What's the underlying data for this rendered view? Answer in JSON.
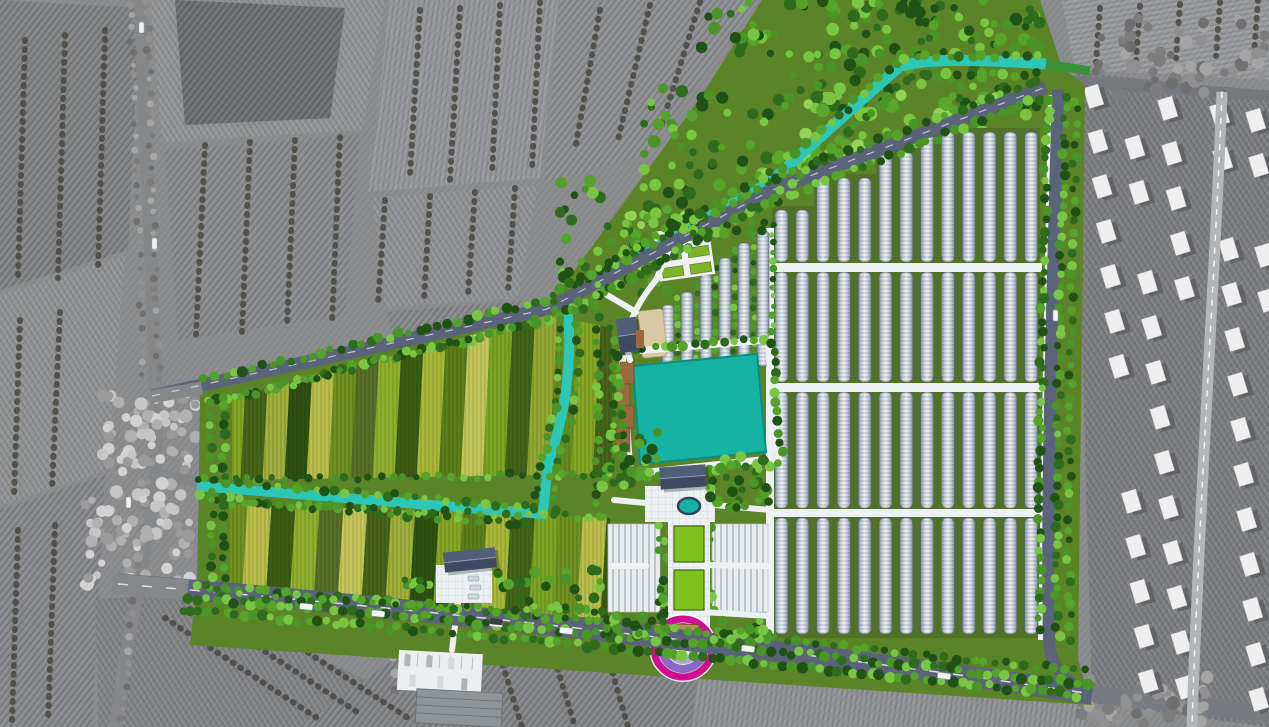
{
  "meta": {
    "title": "Aerial master-plan rendering of an agricultural eco-park",
    "canvas": {
      "w": 1269,
      "h": 727
    }
  },
  "palette": {
    "context_base": "#8a8c8e",
    "context_tones": [
      "#7f8183",
      "#8f9193",
      "#85878a",
      "#909294",
      "#6b6d70",
      "#888a8d",
      "#94969a",
      "#8b8d90",
      "#8f9194",
      "#818386",
      "#8e9092",
      "#97999c",
      "#7c7e81"
    ],
    "context_tree": "#46483f",
    "context_tree_light": [
      "#c6c6c6",
      "#b0b0b0",
      "#9a9a9a",
      "#d2d2d2"
    ],
    "context_tree_gray": [
      "#909090",
      "#7d7d7d",
      "#a5a5a5",
      "#6f6f6f"
    ],
    "context_road": "#858789",
    "village_road": "#b3b6b9",
    "house_roof": "#efefef",
    "house_shadow": "#5f6064",
    "lawn": "#5a8427",
    "field_under": "#4f7226",
    "site_road": "#59637a",
    "road_dash": "#e8eaec",
    "canal": "#2cc7b6",
    "canal_exit_green": "#3a8f3a",
    "pond": "#16b3a2",
    "pond_edge": "#0d8d80",
    "path_white": "#eef1f3",
    "path_line": "#ccd2d8",
    "tree_greens": [
      "#2e6b1c",
      "#56a32b",
      "#79c544",
      "#1f5214",
      "#4b9428"
    ],
    "tree_bright": [
      "#7cc43f",
      "#5aa52e",
      "#93d355"
    ],
    "farm_north_colors": [
      "#87a826",
      "#49641b",
      "#9fb03b",
      "#2f5212",
      "#b9bf4a",
      "#6f9220",
      "#586f2a",
      "#8fb02c",
      "#3c5c14",
      "#a8b838",
      "#5d7f1b",
      "#c3c75a",
      "#7aa524",
      "#43651a",
      "#93a832",
      "#688b1e"
    ],
    "farm_south_colors": [
      "#6f9220",
      "#b9bf4a",
      "#3c5c14",
      "#8fb02c",
      "#586f2a",
      "#c3c75a",
      "#49641b",
      "#9fb03b",
      "#2f5212",
      "#87a826",
      "#5d7f1b",
      "#a8b838",
      "#43651a",
      "#7aa524"
    ],
    "greenhouse_edge": "#5d6b79",
    "greenhouse_light": "#eef3f5",
    "greenhouse_mid": "#c7d2d9",
    "greenhouse_dark": "#7f93a4",
    "boardwalk": "#9a6a3e",
    "sand": "#d9c9a2",
    "roof_dark": "#3d4a61",
    "roof_dark2": "#55647e",
    "plaza_block": "#e9edef",
    "entrance_ring": "#cf0e92",
    "entrance_band1": "#8a68c6",
    "entrance_band2": "#b9a3dd",
    "gate_bar": "#b98a5c",
    "car_white": "#f2f3f4",
    "car_dark": "#3a3f46"
  },
  "scene": {
    "site_boundary": [
      [
        200,
        390
      ],
      [
        547,
        308
      ],
      [
        700,
        98
      ],
      [
        762,
        0
      ],
      [
        1040,
        0
      ],
      [
        1062,
        68
      ],
      [
        1085,
        85
      ],
      [
        1078,
        660
      ],
      [
        1092,
        705
      ],
      [
        190,
        645
      ],
      [
        197,
        585
      ],
      [
        199,
        478
      ]
    ],
    "context_fields": [
      {
        "pts": [
          [
            0,
            0
          ],
          [
            140,
            8
          ],
          [
            128,
            250
          ],
          [
            0,
            290
          ]
        ],
        "tone": 0,
        "hatch": "h1"
      },
      {
        "pts": [
          [
            0,
            295
          ],
          [
            125,
            255
          ],
          [
            108,
            470
          ],
          [
            0,
            505
          ]
        ],
        "tone": 1,
        "hatch": "h2"
      },
      {
        "pts": [
          [
            0,
            510
          ],
          [
            105,
            475
          ],
          [
            92,
            727
          ],
          [
            0,
            727
          ]
        ],
        "tone": 2,
        "hatch": "h1"
      },
      {
        "pts": [
          [
            150,
            0
          ],
          [
            385,
            0
          ],
          [
            362,
            130
          ],
          [
            162,
            142
          ]
        ],
        "tone": 3,
        "hatch": "h2"
      },
      {
        "pts": [
          [
            175,
            0
          ],
          [
            345,
            8
          ],
          [
            330,
            118
          ],
          [
            185,
            125
          ]
        ],
        "tone": 4,
        "hatch": "h1"
      },
      {
        "pts": [
          [
            165,
            150
          ],
          [
            360,
            135
          ],
          [
            345,
            315
          ],
          [
            178,
            340
          ]
        ],
        "tone": 5,
        "hatch": "h1"
      },
      {
        "pts": [
          [
            390,
            0
          ],
          [
            558,
            0
          ],
          [
            540,
            178
          ],
          [
            368,
            192
          ]
        ],
        "tone": 6,
        "hatch": "h3"
      },
      {
        "pts": [
          [
            560,
            0
          ],
          [
            758,
            0
          ],
          [
            645,
            155
          ],
          [
            545,
            182
          ]
        ],
        "tone": 7,
        "hatch": "h1"
      },
      {
        "pts": [
          [
            372,
            198
          ],
          [
            538,
            185
          ],
          [
            518,
            298
          ],
          [
            385,
            308
          ]
        ],
        "tone": 8,
        "hatch": "h2"
      },
      {
        "pts": [
          [
            388,
            312
          ],
          [
            532,
            300
          ],
          [
            430,
            358
          ],
          [
            396,
            354
          ]
        ],
        "tone": 2,
        "hatch": "h1"
      },
      {
        "pts": [
          [
            95,
            600
          ],
          [
            178,
            592
          ],
          [
            420,
            705
          ],
          [
            330,
            727
          ],
          [
            98,
            727
          ]
        ],
        "tone": 9,
        "hatch": "h2"
      },
      {
        "pts": [
          [
            300,
            727
          ],
          [
            420,
            640
          ],
          [
            700,
            662
          ],
          [
            690,
            727
          ]
        ],
        "tone": 9,
        "hatch": "h1"
      },
      {
        "pts": [
          [
            690,
            727
          ],
          [
            700,
            662
          ],
          [
            1090,
            700
          ],
          [
            1085,
            727
          ]
        ],
        "tone": 10,
        "hatch": "h3"
      },
      {
        "pts": [
          [
            1062,
            0
          ],
          [
            1269,
            0
          ],
          [
            1269,
            80
          ],
          [
            1075,
            70
          ]
        ],
        "tone": 11,
        "hatch": "hv"
      },
      {
        "pts": [
          [
            1075,
            72
          ],
          [
            1269,
            92
          ],
          [
            1269,
            727
          ],
          [
            1092,
            703
          ]
        ],
        "tone": 12,
        "hatch": "h2"
      }
    ],
    "context_tree_rows": [
      [
        [
          420,
          10
        ],
        [
          410,
          175
        ]
      ],
      [
        [
          460,
          8
        ],
        [
          450,
          180
        ]
      ],
      [
        [
          500,
          5
        ],
        [
          492,
          175
        ]
      ],
      [
        [
          540,
          2
        ],
        [
          532,
          170
        ]
      ],
      [
        [
          205,
          145
        ],
        [
          196,
          335
        ]
      ],
      [
        [
          250,
          142
        ],
        [
          242,
          332
        ]
      ],
      [
        [
          295,
          140
        ],
        [
          287,
          328
        ]
      ],
      [
        [
          340,
          137
        ],
        [
          332,
          322
        ]
      ],
      [
        [
          385,
          200
        ],
        [
          378,
          305
        ]
      ],
      [
        [
          430,
          196
        ],
        [
          424,
          300
        ]
      ],
      [
        [
          475,
          192
        ],
        [
          468,
          296
        ]
      ],
      [
        [
          515,
          188
        ],
        [
          508,
          292
        ]
      ],
      [
        [
          600,
          10
        ],
        [
          575,
          150
        ]
      ],
      [
        [
          650,
          5
        ],
        [
          618,
          140
        ]
      ],
      [
        [
          700,
          2
        ],
        [
          660,
          130
        ]
      ],
      [
        [
          25,
          40
        ],
        [
          18,
          280
        ]
      ],
      [
        [
          65,
          35
        ],
        [
          58,
          278
        ]
      ],
      [
        [
          105,
          30
        ],
        [
          98,
          272
        ]
      ],
      [
        [
          20,
          320
        ],
        [
          14,
          495
        ]
      ],
      [
        [
          60,
          312
        ],
        [
          52,
          488
        ]
      ],
      [
        [
          18,
          530
        ],
        [
          12,
          722
        ]
      ],
      [
        [
          55,
          525
        ],
        [
          48,
          722
        ]
      ],
      [
        [
          165,
          618
        ],
        [
          320,
          720
        ]
      ],
      [
        [
          205,
          612
        ],
        [
          360,
          714
        ]
      ],
      [
        [
          255,
          618
        ],
        [
          408,
          718
        ]
      ],
      [
        [
          445,
          652
        ],
        [
          470,
          727
        ]
      ],
      [
        [
          500,
          656
        ],
        [
          522,
          727
        ]
      ],
      [
        [
          555,
          660
        ],
        [
          575,
          727
        ]
      ],
      [
        [
          610,
          664
        ],
        [
          628,
          727
        ]
      ],
      [
        [
          1100,
          8
        ],
        [
          1096,
          62
        ]
      ],
      [
        [
          1140,
          6
        ],
        [
          1136,
          60
        ]
      ],
      [
        [
          1180,
          4
        ],
        [
          1176,
          58
        ]
      ],
      [
        [
          1220,
          2
        ],
        [
          1216,
          56
        ]
      ],
      [
        [
          1258,
          0
        ],
        [
          1254,
          54
        ]
      ]
    ],
    "farm_north": {
      "poly": [
        [
          232,
          398
        ],
        [
          548,
          315
        ],
        [
          612,
          328
        ],
        [
          612,
          474
        ],
        [
          232,
          480
        ]
      ],
      "x0": 228,
      "x1": 616,
      "strip_w": 22,
      "lean": 10,
      "y_top": 300,
      "y_bot": 490
    },
    "farm_south": {
      "poly": [
        [
          228,
          504
        ],
        [
          610,
          518
        ],
        [
          608,
          618
        ],
        [
          436,
          612
        ],
        [
          228,
          598
        ]
      ],
      "x0": 224,
      "x1": 614,
      "strip_w": 24,
      "lean": 8,
      "y_top": 498,
      "y_bot": 625
    },
    "canal_ne": "M566,300 L770,182 L900,66 C925,60 960,58 1046,64",
    "canal_exit": "M1046,64 L1090,71",
    "canal_sw": "M566,300 C574,352 566,408 552,452 C543,480 547,498 542,514 L197,486",
    "nw_road": "M152,396 L547,309 L770,191 L1046,87",
    "nw_road_gray": "M150,397 L202,388",
    "east_road": "M1058,90 C1052,300 1046,520 1049,640 C1050,668 1066,682 1088,693",
    "bottom_road": "M118,584 C400,606 800,650 1092,694",
    "bottom_road_gray": "M112,584 L188,590",
    "bottom_road_ext": "M1092,694 L1269,714",
    "left_road": "M140,0 C148,200 160,420 155,478 C150,540 125,640 116,727",
    "west_stub_road": "M152,474 L199,482",
    "village_v_road": "M1222,92 C1216,250 1204,430 1197,600 C1194,660 1193,695 1192,727",
    "tr_h_road": "M1062,80 L1269,96",
    "greenhouse_field": {
      "x0": 775,
      "spacing": 20.8,
      "row_w": 13,
      "rows": 13,
      "under": [
        [
          [
            772,
            206
          ],
          [
            814,
            206
          ],
          [
            814,
            174
          ],
          [
            876,
            174
          ],
          [
            876,
            148
          ],
          [
            918,
            148
          ],
          [
            918,
            128
          ],
          [
            1040,
            128
          ],
          [
            1040,
            266
          ],
          [
            772,
            266
          ]
        ],
        [
          [
            772,
            268
          ],
          [
            1040,
            268
          ],
          [
            1040,
            386
          ],
          [
            772,
            386
          ]
        ],
        [
          [
            772,
            388
          ],
          [
            1040,
            388
          ],
          [
            1040,
            512
          ],
          [
            772,
            512
          ]
        ],
        [
          [
            772,
            514
          ],
          [
            1040,
            514
          ],
          [
            1040,
            638
          ],
          [
            772,
            638
          ]
        ]
      ],
      "bands": [
        {
          "y1": 262,
          "tops": [
            210,
            210,
            178,
            178,
            178,
            152,
            152,
            132,
            132,
            132,
            132,
            132,
            132
          ]
        },
        {
          "y0": 272,
          "y1": 382
        },
        {
          "y0": 392,
          "y1": 508
        },
        {
          "y0": 518,
          "y1": 634
        }
      ],
      "h_paths": [
        [
          770,
          263,
          272,
          9
        ],
        [
          770,
          383,
          272,
          9
        ],
        [
          770,
          509,
          272,
          8
        ]
      ],
      "v_path_w": "M770,228 L770,640",
      "v_path_e": "M1052,95 L1042,640"
    },
    "nursery": {
      "xs": [
        662,
        681,
        700,
        719,
        738,
        757
      ],
      "tops": [
        305,
        292,
        275,
        258,
        243,
        231
      ],
      "bottom": 366,
      "w": 12
    },
    "garden_plots": {
      "x": 656,
      "y": 228,
      "w": 56,
      "h": 50,
      "rot": -8,
      "cols": 2,
      "rows": 3
    },
    "sand": {
      "x": 640,
      "y": 310,
      "w": 25,
      "h": 47,
      "rot": -6
    },
    "pond": {
      "pts": [
        [
          633,
          366
        ],
        [
          757,
          354
        ],
        [
          766,
          452
        ],
        [
          640,
          464
        ]
      ],
      "loop": [
        [
          622,
          352
        ],
        [
          768,
          340
        ],
        [
          778,
          458
        ],
        [
          630,
          474
        ]
      ]
    },
    "boardwalk": [
      [
        620,
        362,
        14,
        22
      ],
      [
        616,
        384,
        14,
        22
      ],
      [
        620,
        406,
        14,
        22
      ],
      [
        616,
        428,
        14,
        24
      ]
    ],
    "axis": {
      "path": [
        668,
        492,
        42,
        150
      ],
      "plaza": [
        645,
        486,
        70,
        36
      ],
      "fountain": [
        689,
        506,
        11,
        8
      ],
      "planters": [
        [
          674,
          526,
          30,
          36
        ],
        [
          674,
          570,
          30,
          40
        ]
      ],
      "block_left": [
        608,
        524,
        52,
        88
      ],
      "block_right": [
        712,
        524,
        56,
        88
      ]
    },
    "entrance": {
      "cx": 683,
      "cy": 648,
      "r_ring": 29,
      "r_b1": 21,
      "r_b2": 13,
      "gate": [
        655,
        624,
        44,
        9
      ]
    },
    "buildings": {
      "nw": {
        "x": 618,
        "y": 318,
        "w": 20,
        "h": 34,
        "rot": -8,
        "deck": [
          636,
          330,
          8,
          18
        ]
      },
      "pond_s": {
        "x": 660,
        "y": 466,
        "w": 46,
        "h": 22,
        "rot": -4
      },
      "west": {
        "x": 444,
        "y": 550,
        "w": 52,
        "h": 20,
        "rot": -6,
        "plaza": [
          436,
          565,
          56,
          38
        ]
      },
      "parking": {
        "lot": [
          398,
          652,
          84,
          40
        ],
        "bldg": [
          418,
          690,
          86,
          34
        ],
        "rot": 3
      }
    },
    "site_paths": [
      "M646,503 L614,500",
      "M630,360 C620,332 638,302 656,280",
      "M636,312 L602,292",
      "M458,602 L452,650",
      "M702,565 L770,566",
      "M702,612 L770,616",
      "M612,566 L646,566",
      "M714,505 L770,510",
      "M656,280 L668,252"
    ],
    "cars_road": [
      [
        300,
        603,
        6
      ],
      [
        372,
        610,
        6
      ],
      [
        560,
        627,
        7
      ],
      [
        742,
        645,
        7
      ],
      [
        938,
        672,
        8
      ],
      [
        490,
        620,
        6
      ]
    ],
    "cars_vert": [
      [
        139,
        22
      ],
      [
        152,
        238
      ],
      [
        126,
        497
      ],
      [
        1053,
        310
      ]
    ],
    "village": {
      "x0": 1086,
      "col_dx": 37,
      "row_dy": 45,
      "rows": 14,
      "cols": 5,
      "house_w": 15,
      "house_h": 21,
      "rot": -17
    }
  }
}
